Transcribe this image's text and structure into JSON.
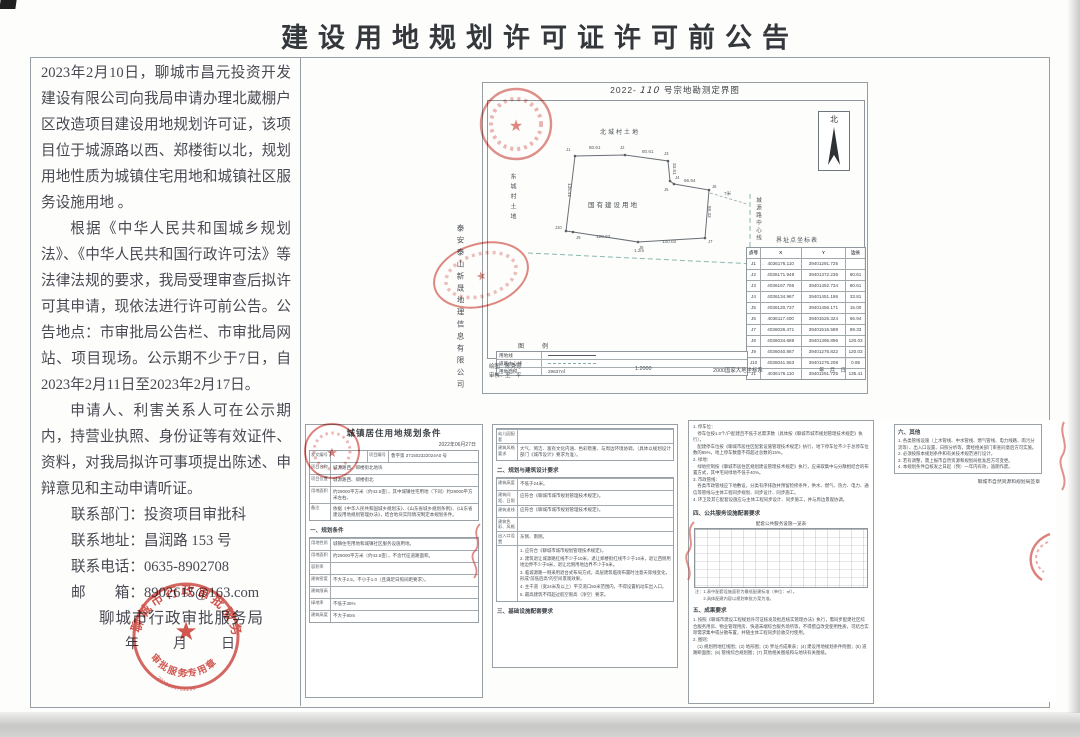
{
  "page": {
    "title": "建设用地规划许可证许可前公告"
  },
  "colors": {
    "seal_red": "#cc4038",
    "frame_gray": "#979ea3",
    "dash_teal": "#8ab8b0"
  },
  "notice": {
    "p1": "2023年2月10日，聊城市昌元投资开发建设有限公司向我局申请办理北葳棚户区改造项目建设用地规划许可证，该项目位于城源路以西、郑楼街以北，规划用地性质为城镇住宅用地和城镇社区服务设施用地 。",
    "p2": "根据《中华人民共和国城乡规划法》、《中华人民共和国行政许可法》等法律法规的要求，我局受理审查后拟许可其申请，现依法进行许可前公告。公告地点：市审批局公告栏、市审批局网站、项目现场。公示期不少于7日，自2023年2月11日至2023年2月17日。",
    "p3": "申请人、利害关系人可在公示期内，持营业执照、身份证等有效证件、资料，对我局拟许可事项提出陈述、申辩意见和主动申请听证。",
    "contacts": [
      "联系部门：投资项目审批科",
      "联系地址：昌润路 153 号",
      "联系电话：0635-8902708",
      "邮　　箱：8902615@163.com"
    ],
    "agency": "聊城市行政审批服务局",
    "date_line": "年　月　日"
  },
  "seal": {
    "ring": "聊城市行政审批服务局",
    "arc": "审批服务专用章",
    "num": "（2）",
    "code": "2019100702290",
    "star": "★"
  },
  "map": {
    "title_prefix": "2022-",
    "title_no": "110",
    "title_suffix": "号宗地勘测定界图",
    "north": "北",
    "labels": {
      "top": "北城村土地",
      "left": "东城村土地",
      "center": "国有建设用地",
      "road": "城源路中心线",
      "table": "界址点坐标表"
    },
    "edges": {
      "top1": "80.61",
      "top2": "80.61",
      "right1": "33.81",
      "right2": "66.94",
      "right3": "89.33",
      "left": "135.41",
      "bottom1": "120.03",
      "bottom2": "120.03",
      "offset": "1.2m",
      "gap": "7米"
    },
    "points": [
      "J1",
      "J2",
      "J3",
      "J4",
      "J5",
      "J6",
      "J7",
      "J8",
      "J9",
      "J10"
    ],
    "legend": {
      "title": "图　例",
      "rows": [
        {
          "k": "用地线",
          "v": ""
        },
        {
          "k": "道路中心线",
          "v": ""
        },
        {
          "k": "用地面积",
          "v": "29637㎡"
        }
      ]
    },
    "coords": {
      "headers": [
        "点号",
        "X",
        "Y",
        "边长"
      ],
      "rows": [
        [
          "J1",
          "4036176.110",
          "39401291.725",
          ""
        ],
        [
          "J2",
          "4036171.948",
          "39401372.236",
          "80.61"
        ],
        [
          "J3",
          "4036167.766",
          "39401452.734",
          "80.61"
        ],
        [
          "J4",
          "4036134.967",
          "39401451.186",
          "33.81"
        ],
        [
          "J5",
          "4036120.737",
          "39401456.171",
          "15.00"
        ],
        [
          "J6",
          "4036117.400",
          "39401525.324",
          "66.94"
        ],
        [
          "J7",
          "4036026.471",
          "39401516.589",
          "89.33"
        ],
        [
          "J8",
          "4036034.689",
          "39401396.896",
          "120.03"
        ],
        [
          "J9",
          "4036040.867",
          "39401276.822",
          "120.03"
        ],
        [
          "J10",
          "4036041.563",
          "39401276.208",
          "0.95"
        ],
        [
          "J1",
          "4036176.110",
          "39401291.725",
          "135.41"
        ]
      ]
    },
    "footer": {
      "draw": "绘图：陈秀芳",
      "check": "审核：王　平",
      "scale": "1:2000",
      "datum": "2000国家大地坐标系",
      "date": "年　月　日"
    },
    "company": "泰安泰山新晟地理信息有限公司"
  },
  "panels": {
    "p1": {
      "title": "城镇居住用地规划条件",
      "date": "2022年06月27日",
      "no_label": "发文编号",
      "no_value": "",
      "pno_label": "项目编号",
      "pno_value": "鲁字第 371502322024A0 号",
      "head_rows": [
        {
          "l": "项目名称",
          "v": "城源路西、郑楼街北地块"
        },
        {
          "l": "项目位置",
          "v": "城源路西、郑楼街北"
        },
        {
          "l": "用地面积",
          "v": "约29000平方米（约43.5亩），其中城镇住宅用地（下同）约29000平方米左右。"
        },
        {
          "l": "备注",
          "v": "依据《中华人民共和国城乡规划法》、《山东省城乡规划条例》、《山东省建设用地规划管理办法》，结合地块实际情况制定本规划条件。"
        }
      ],
      "section": "一、规划条件",
      "cond_rows": [
        {
          "l": "用地性质",
          "v": "城镇住宅用地和城镇社区服务设施用地。"
        },
        {
          "l": "用地面积",
          "v": "约29000平方米（约43.5亩），不含代征道路面积。"
        },
        {
          "l": "容积率",
          "v": ""
        },
        {
          "l": "建筑密度",
          "v": "不大于2.5，不小于1.0（且满足日照间距要求）。"
        },
        {
          "l": "建筑限高",
          "v": ""
        },
        {
          "l": "绿地率",
          "v": "不低于35%"
        },
        {
          "l": "建筑高度",
          "v": "不大于80m"
        }
      ]
    },
    "p2": {
      "rows1": [
        {
          "l": "幼儿园配套",
          "v": ""
        },
        {
          "l": "建筑风格要求",
          "v": "大气、简洁、富有文化内涵、色彩稳重、与周边环境协调，（具体以规划设计部门《城市设计》要求为准）。"
        }
      ],
      "section": "二、规划与建筑设计要求",
      "rows2": [
        {
          "l": "建筑高度",
          "v": "不低于24米。"
        },
        {
          "l": "建筑间距、日照",
          "v": "应符合《聊城市城市规划管理技术规定》。"
        },
        {
          "l": "建筑退线",
          "v": "应符合《聊城市城市规划管理技术规定》。"
        },
        {
          "l": "建筑色彩、风格",
          "v": ""
        },
        {
          "l": "出入口设置",
          "v": "东侧、南侧。"
        }
      ],
      "list": [
        "1. 应符合《聊城市城市规划管理技术规定》。",
        "2. 建筑退让城源路红线不少于10米，退让郑楼街红线不少于10米，退让西侧用地边界不少于9米，退让北侧用地边界不少于9米。",
        "3. 临城源路一侧采用退台式布局方式，高层建筑临街布置时注意天际线变化，形成“前低后高”的空间景观效果。",
        "4. 主干道（宽24米及以上）平交道口50米范围内，不得设置机动车出入口。",
        "5. 最高建筑不得超过航空限高（净空）要求。"
      ],
      "section_end": "三、基础设施配套要求"
    },
    "p3": {
      "paras": [
        "1. 停车位：",
        "　停车位按1.0个/户配建且不低于总需求数（具体按《聊城市城市规划管理技术规定》执行）。",
        "　配建停车位按《聊城市居住区配套设施管理技术规定》执行，地下停车位不少于总停车位数的85%，地上停车数量不得超过总数的15%。",
        "2. 绿地：",
        "　绿地控制按《聊城市居住区规划建设管理技术规定》执行，应采取集中与分散相结合的布置方式，其中宅间绿地不低于40%。",
        "3. 市政管线：",
        "　各类市政管线应下地敷设，分类有序排放并预留检修条件，供水、燃气、热力、电力、通信等管线与主体工程同步规划、同步设计、同步施工。",
        "4. 环卫及其它配套设施应与主体工程同步设计、同步施工，并与周边景观协调。"
      ],
      "section4": "四、公共服务设施配套要求",
      "table_title": "配套公共服务设施一览表",
      "notes": [
        "注：1.表中配套设施面积为最低配建标准（单位：㎡）。",
        "　　2.具体配建内容以规划审批方案为准。"
      ],
      "section5": "五、成果要求",
      "paras2": [
        "1. 按照《聊城市建设工程规划许可证核发及批后核实管理办法》执行，需同步配建社区综合服务用房、物业管理用房、快递末端综合服务场所等，不得擅自改变使用性质，可结合实际需求集中或分散布置，并随主体工程同步验收交付使用。",
        "2. 图则：",
        "　(1) 规划用地红线图；(2) 地形图；(3) 界址点成果表；(4) 建设用地规划条件附图；(5) 道路断面图；(6) 管线综合规划图；(7) 其他相关图纸和与地块有关图纸。"
      ]
    },
    "p4": {
      "section": "六、其他",
      "items": [
        "1. 各类管线设施（上水管线、中水管线、燃气管线、电力线路、雨污分流等）、出入口设置、日照分析等，需经相关部门审查同意后方可实施。",
        "2. 必须按照本规划条件和有关技术规范进行设计。",
        "3. 若有调整，需上报市自然资源和规划局批准后方可变更。",
        "4. 本规划条件自核发之日起（预）一年内有效，逾期作废。"
      ],
      "signature": "聊城市自然资源和规划局签章"
    }
  }
}
